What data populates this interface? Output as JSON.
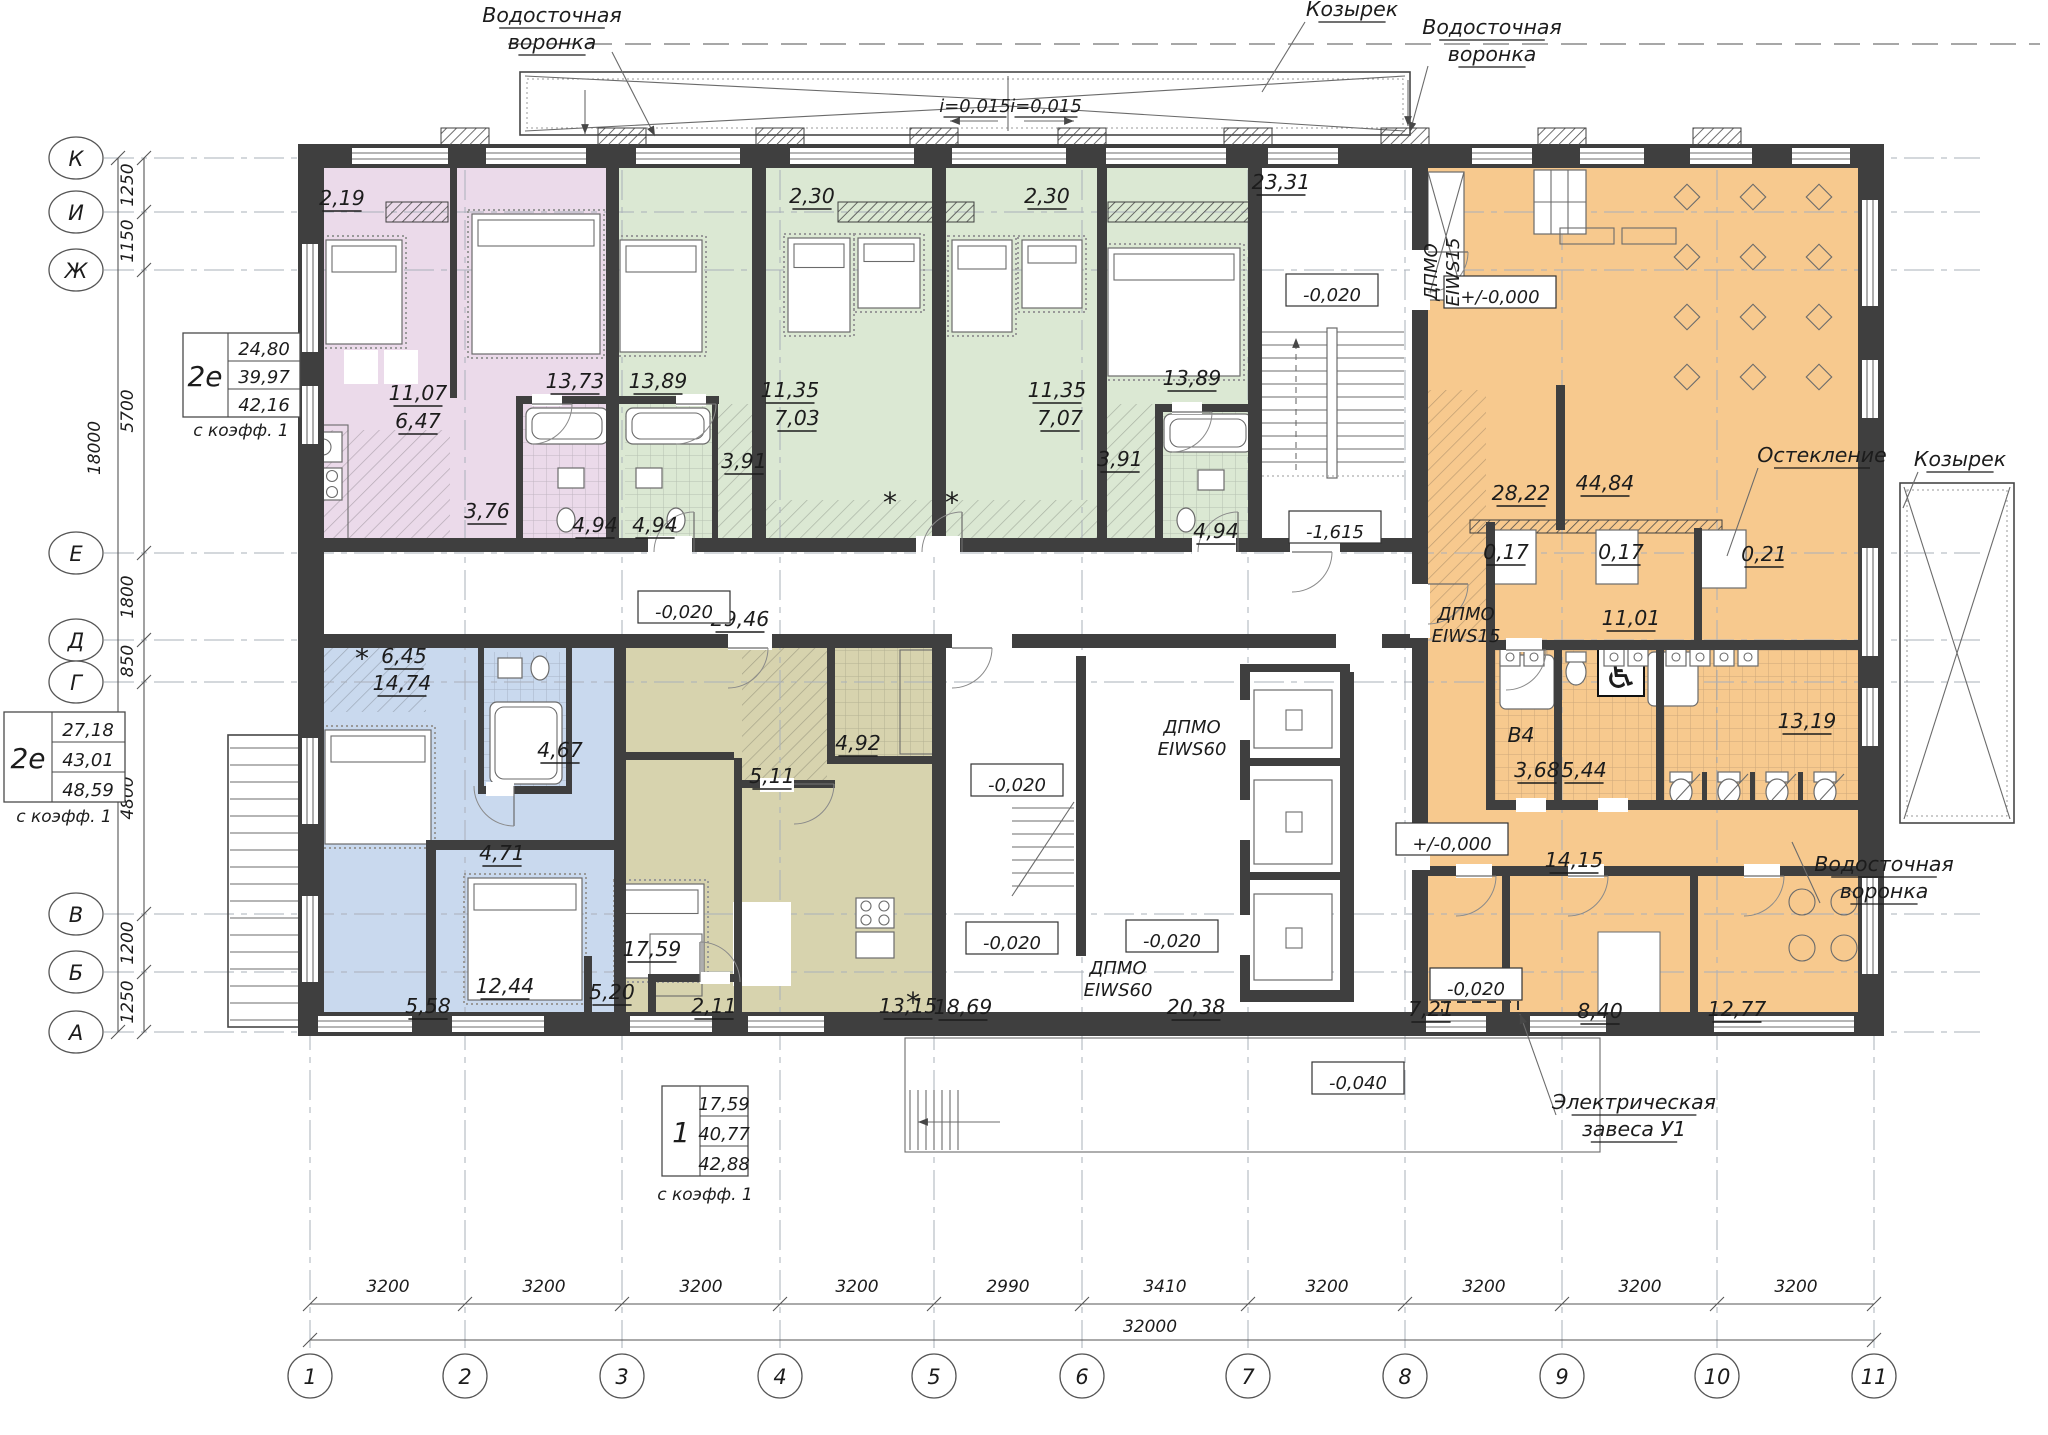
{
  "colors": {
    "pink": "#ebdaea",
    "green": "#dbe8d3",
    "blue": "#c9d9ee",
    "olive": "#d7d3ae",
    "orange": "#f7c98e",
    "wall": "#3f3f3f",
    "accent_line": "#555555"
  },
  "axes": {
    "columns": [
      {
        "label": "1",
        "x": 310
      },
      {
        "label": "2",
        "x": 465
      },
      {
        "label": "3",
        "x": 622
      },
      {
        "label": "4",
        "x": 780
      },
      {
        "label": "5",
        "x": 934
      },
      {
        "label": "6",
        "x": 1082
      },
      {
        "label": "7",
        "x": 1248
      },
      {
        "label": "8",
        "x": 1405
      },
      {
        "label": "9",
        "x": 1562
      },
      {
        "label": "10",
        "x": 1717
      },
      {
        "label": "11",
        "x": 1874
      }
    ],
    "rows": [
      {
        "label": "К",
        "y": 158
      },
      {
        "label": "И",
        "y": 212
      },
      {
        "label": "Ж",
        "y": 270
      },
      {
        "label": "Е",
        "y": 553
      },
      {
        "label": "Д",
        "y": 640
      },
      {
        "label": "Г",
        "y": 682
      },
      {
        "label": "В",
        "y": 914
      },
      {
        "label": "Б",
        "y": 972
      },
      {
        "label": "А",
        "y": 1032
      }
    ],
    "bottom_dims": {
      "segments": [
        {
          "text": "3200",
          "cx": 388
        },
        {
          "text": "3200",
          "cx": 544
        },
        {
          "text": "3200",
          "cx": 701
        },
        {
          "text": "3200",
          "cx": 857
        },
        {
          "text": "2990",
          "cx": 1008
        },
        {
          "text": "3410",
          "cx": 1165
        },
        {
          "text": "3200",
          "cx": 1327
        },
        {
          "text": "3200",
          "cx": 1484
        },
        {
          "text": "3200",
          "cx": 1640
        },
        {
          "text": "3200",
          "cx": 1796
        }
      ],
      "total": {
        "text": "32000",
        "cx": 1150,
        "cy": 1332
      }
    },
    "left_dims": {
      "segments": [
        {
          "text": "1250",
          "cy": 185
        },
        {
          "text": "1150",
          "cy": 241
        },
        {
          "text": "5700",
          "cy": 411
        },
        {
          "text": "1800",
          "cy": 597
        },
        {
          "text": "850",
          "cy": 661
        },
        {
          "text": "4800",
          "cy": 798
        },
        {
          "text": "1200",
          "cy": 943
        },
        {
          "text": "1250",
          "cy": 1002
        }
      ],
      "total": {
        "text": "18000",
        "cx": 100,
        "cy": 448
      }
    }
  },
  "apt_tables": {
    "t2e_top": {
      "type": "2е",
      "rows": [
        "24,80",
        "39,97",
        "42,16"
      ],
      "note": "с коэфф. 1"
    },
    "t2e_left": {
      "type": "2е",
      "rows": [
        "27,18",
        "43,01",
        "48,59"
      ],
      "note": "с коэфф. 1"
    },
    "t1_bottom": {
      "type": "1",
      "rows": [
        "17,59",
        "40,77",
        "42,88"
      ],
      "note": "с коэфф. 1"
    }
  },
  "area_labels": [
    {
      "t": "2,19",
      "x": 342,
      "y": 205
    },
    {
      "t": "11,07",
      "x": 418,
      "y": 400
    },
    {
      "t": "6,47",
      "x": 418,
      "y": 428
    },
    {
      "t": "13,73",
      "x": 575,
      "y": 388
    },
    {
      "t": "13,89",
      "x": 658,
      "y": 388
    },
    {
      "t": "3,76",
      "x": 487,
      "y": 518
    },
    {
      "t": "4,94",
      "x": 595,
      "y": 532
    },
    {
      "t": "4,94",
      "x": 655,
      "y": 532
    },
    {
      "t": "2,30",
      "x": 812,
      "y": 203
    },
    {
      "t": "11,35",
      "x": 790,
      "y": 397
    },
    {
      "t": "7,03",
      "x": 797,
      "y": 425
    },
    {
      "t": "3,91",
      "x": 744,
      "y": 468
    },
    {
      "t": "2,30",
      "x": 1047,
      "y": 203
    },
    {
      "t": "11,35",
      "x": 1057,
      "y": 397
    },
    {
      "t": "7,07",
      "x": 1060,
      "y": 425
    },
    {
      "t": "3,91",
      "x": 1120,
      "y": 466
    },
    {
      "t": "13,89",
      "x": 1192,
      "y": 385
    },
    {
      "t": "4,94",
      "x": 1216,
      "y": 538
    },
    {
      "t": "23,31",
      "x": 1281,
      "y": 189
    },
    {
      "t": "29,46",
      "x": 740,
      "y": 626
    },
    {
      "t": "18,69",
      "x": 963,
      "y": 1014
    },
    {
      "t": "20,38",
      "x": 1196,
      "y": 1014
    },
    {
      "t": "6,45",
      "x": 404,
      "y": 663
    },
    {
      "t": "14,74",
      "x": 402,
      "y": 690
    },
    {
      "t": "4,67",
      "x": 560,
      "y": 757
    },
    {
      "t": "4,71",
      "x": 502,
      "y": 860
    },
    {
      "t": "12,44",
      "x": 505,
      "y": 993
    },
    {
      "t": "5,58",
      "x": 428,
      "y": 1013
    },
    {
      "t": "5,20",
      "x": 612,
      "y": 999
    },
    {
      "t": "17,59",
      "x": 652,
      "y": 956
    },
    {
      "t": "5,11",
      "x": 772,
      "y": 783
    },
    {
      "t": "4,92",
      "x": 858,
      "y": 750
    },
    {
      "t": "2,11",
      "x": 714,
      "y": 1013
    },
    {
      "t": "13,15",
      "x": 908,
      "y": 1013
    },
    {
      "t": "28,22",
      "x": 1521,
      "y": 500
    },
    {
      "t": "44,84",
      "x": 1605,
      "y": 490
    },
    {
      "t": "0,17",
      "x": 1506,
      "y": 559
    },
    {
      "t": "0,17",
      "x": 1621,
      "y": 559
    },
    {
      "t": "0,21",
      "x": 1764,
      "y": 561
    },
    {
      "t": "11,01",
      "x": 1631,
      "y": 625
    },
    {
      "t": "В4",
      "x": 1521,
      "y": 742,
      "u": 0
    },
    {
      "t": "3,68",
      "x": 1537,
      "y": 777
    },
    {
      "t": "5,44",
      "x": 1584,
      "y": 777
    },
    {
      "t": "13,19",
      "x": 1807,
      "y": 728
    },
    {
      "t": "14,15",
      "x": 1574,
      "y": 867
    },
    {
      "t": "7,21",
      "x": 1431,
      "y": 1016
    },
    {
      "t": "8,40",
      "x": 1600,
      "y": 1018
    },
    {
      "t": "12,77",
      "x": 1737,
      "y": 1016
    }
  ],
  "elevation_marks": [
    {
      "t": "-0,020",
      "x": 1332,
      "y": 296
    },
    {
      "t": "-1,615",
      "x": 1335,
      "y": 533
    },
    {
      "t": "+/-0,000",
      "x": 1500,
      "y": 298,
      "w": 112
    },
    {
      "t": "-0,020",
      "x": 684,
      "y": 613
    },
    {
      "t": "-0,020",
      "x": 1017,
      "y": 786
    },
    {
      "t": "-0,020",
      "x": 1012,
      "y": 944
    },
    {
      "t": "-0,020",
      "x": 1172,
      "y": 942
    },
    {
      "t": "+/-0,000",
      "x": 1452,
      "y": 845,
      "w": 112
    },
    {
      "t": "-0,020",
      "x": 1476,
      "y": 990
    },
    {
      "t": "-0,040",
      "x": 1358,
      "y": 1084
    }
  ],
  "notes": [
    {
      "lines": [
        "ДПМО",
        "EIWS15"
      ],
      "x": 1437,
      "y": 272,
      "rot": -90
    },
    {
      "lines": [
        "ДПМО",
        "EIWS15"
      ],
      "x": 1466,
      "y": 620
    },
    {
      "lines": [
        "ДПМО",
        "EIWS60"
      ],
      "x": 1192,
      "y": 733
    },
    {
      "lines": [
        "ДПМО",
        "EIWS60"
      ],
      "x": 1118,
      "y": 974
    },
    {
      "lines": [
        "i=0,015"
      ],
      "x": 975,
      "y": 112,
      "u": 1
    },
    {
      "lines": [
        "i=0,015"
      ],
      "x": 1046,
      "y": 112,
      "u": 1
    }
  ],
  "callouts": [
    {
      "lines": [
        "Водосточная",
        "воронка"
      ],
      "x": 552,
      "y": 22
    },
    {
      "lines": [
        "Козырек"
      ],
      "x": 1352,
      "y": 16
    },
    {
      "lines": [
        "Водосточная",
        "воронка"
      ],
      "x": 1492,
      "y": 34
    },
    {
      "lines": [
        "Остекление"
      ],
      "x": 1822,
      "y": 462
    },
    {
      "lines": [
        "Козырек"
      ],
      "x": 1960,
      "y": 466
    },
    {
      "lines": [
        "Водосточная",
        "воронка"
      ],
      "x": 1884,
      "y": 871
    },
    {
      "lines": [
        "Электрическая",
        "завеса У1"
      ],
      "x": 1634,
      "y": 1109
    }
  ]
}
